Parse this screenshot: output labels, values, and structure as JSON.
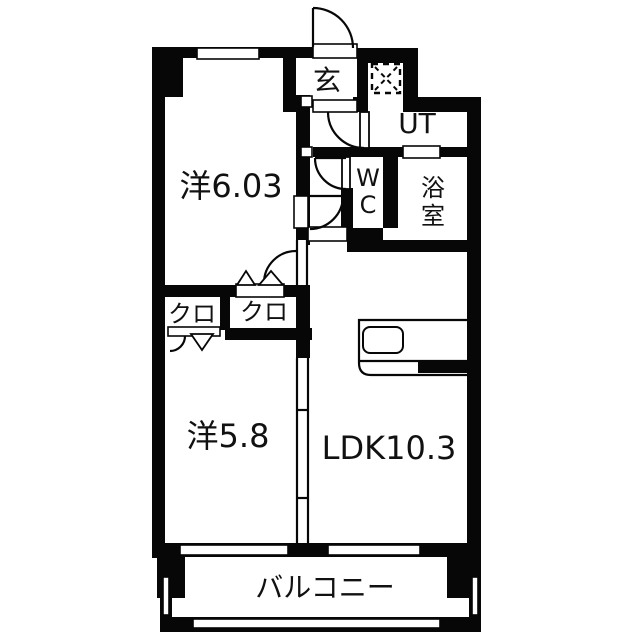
{
  "floorplan": {
    "type": "japanese-apartment-floorplan",
    "colors": {
      "wall": "#070707",
      "floor": "#ffffff",
      "background": "#ffffff",
      "text": "#111111"
    },
    "rooms": {
      "genkan": {
        "label": "玄",
        "meaning": "entrance"
      },
      "ut": {
        "label": "UT",
        "meaning": "utility"
      },
      "wc": {
        "label_line1": "W",
        "label_line2": "C",
        "meaning": "toilet"
      },
      "bath": {
        "label_line1": "浴",
        "label_line2": "室",
        "meaning": "bathroom"
      },
      "western_6_03": {
        "label": "洋6.03",
        "meaning": "western-style room 6.03 mats"
      },
      "western_5_8": {
        "label": "洋5.8",
        "meaning": "western-style room 5.8 mats"
      },
      "ldk": {
        "label": "LDK10.3",
        "meaning": "living-dining-kitchen 10.3 mats"
      },
      "closet_left": {
        "label": "クロ",
        "meaning": "closet"
      },
      "closet_right": {
        "label": "クロ",
        "meaning": "closet"
      },
      "balcony": {
        "label": "バルコニー",
        "meaning": "balcony"
      }
    },
    "symbols": {
      "washing_machine_area": "dashed square with X",
      "door_swings": "quarter-circle arcs",
      "folding_closet_doors": "triangle markers",
      "kitchen": "counter with sink"
    }
  }
}
